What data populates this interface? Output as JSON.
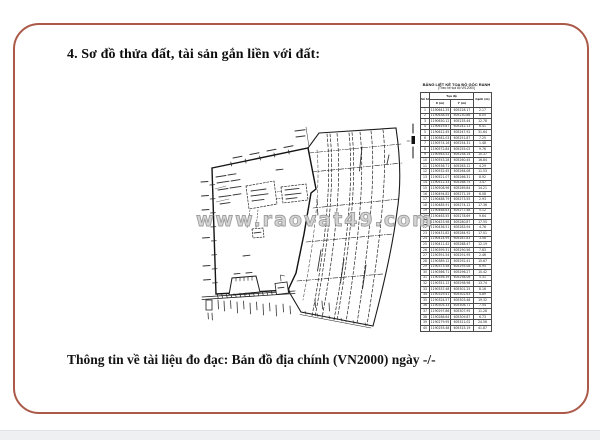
{
  "page": {
    "title": "4. Sơ đồ thửa đất, tài sản gắn liền với đất:",
    "footer": "Thông tin về tài liệu đo đạc: Bản đồ địa chính (VN2000) ngày -/-",
    "watermark": "www.raovat49.com",
    "frame_color": "#ab5948"
  },
  "coordinate_table": {
    "title_line1": "BẢNG LIỆT KÊ TỌA ĐỘ GÓC RANH",
    "title_line2": "(Theo hệ tọa độ VN-2000)",
    "headers": {
      "point": "Số hiệu điểm",
      "coords": "Tọa độ",
      "x": "X (m)",
      "y": "Y (m)",
      "edge": "Cạnh (m)"
    },
    "rows": [
      {
        "n": "1",
        "x": "1190641.25",
        "y": "605228.17",
        "d": "2.17"
      },
      {
        "n": "2",
        "x": "1190638.54",
        "y": "605230.86",
        "d": "8.05"
      },
      {
        "n": "3",
        "x": "1190630.12",
        "y": "605235.44",
        "d": "12.78"
      },
      {
        "n": "4",
        "x": "1190619.87",
        "y": "605242.13",
        "d": "6.41"
      },
      {
        "n": "5",
        "x": "1190612.45",
        "y": "605247.92",
        "d": "31.64"
      },
      {
        "n": "6",
        "x": "1190581.03",
        "y": "605251.87",
        "d": "7.25"
      },
      {
        "n": "7",
        "x": "1190574.16",
        "y": "605254.31",
        "d": "1.48"
      },
      {
        "n": "8",
        "x": "1190572.84",
        "y": "605255.02",
        "d": "9.76"
      },
      {
        "n": "9",
        "x": "1190563.52",
        "y": "605258.14",
        "d": "10.37"
      },
      {
        "n": "10",
        "x": "1190553.28",
        "y": "605260.45",
        "d": "16.84"
      },
      {
        "n": "11",
        "x": "1190536.71",
        "y": "605263.12",
        "d": "4.29"
      },
      {
        "n": "12",
        "x": "1190532.45",
        "y": "605264.08",
        "d": "11.53"
      },
      {
        "n": "13",
        "x": "1190521.07",
        "y": "605266.31",
        "d": "8.92"
      },
      {
        "n": "14",
        "x": "1190512.33",
        "y": "605268.75",
        "d": "3.47"
      },
      {
        "n": "15",
        "x": "1190508.96",
        "y": "605269.84",
        "d": "14.21"
      },
      {
        "n": "16",
        "x": "1190494.82",
        "y": "605272.19",
        "d": "6.08"
      },
      {
        "n": "17",
        "x": "1190488.79",
        "y": "605273.55",
        "d": "2.93"
      },
      {
        "n": "18",
        "x": "1190485.91",
        "y": "605274.12",
        "d": "17.36"
      },
      {
        "n": "19",
        "x": "1190468.63",
        "y": "605277.48",
        "d": "5.12"
      },
      {
        "n": "20",
        "x": "1190463.55",
        "y": "605278.69",
        "d": "9.64"
      },
      {
        "n": "21",
        "x": "1190453.98",
        "y": "605280.87",
        "d": "17.55"
      },
      {
        "n": "22",
        "x": "1190436.51",
        "y": "605283.94",
        "d": "4.76"
      },
      {
        "n": "23",
        "x": "1190431.82",
        "y": "605284.92",
        "d": "17.01"
      },
      {
        "n": "24",
        "x": "1190414.95",
        "y": "605287.83",
        "d": "3.58"
      },
      {
        "n": "25",
        "x": "1190411.42",
        "y": "605288.47",
        "d": "12.19"
      },
      {
        "n": "26",
        "x": "1190399.31",
        "y": "605290.56",
        "d": "7.83"
      },
      {
        "n": "27",
        "x": "1190391.54",
        "y": "605291.95",
        "d": "2.46"
      },
      {
        "n": "28",
        "x": "1190389.12",
        "y": "605292.41",
        "d": "15.67"
      },
      {
        "n": "29",
        "x": "1190373.58",
        "y": "605295.08",
        "d": "6.95"
      },
      {
        "n": "30",
        "x": "1190366.71",
        "y": "605296.27",
        "d": "10.42"
      },
      {
        "n": "31",
        "x": "1190356.39",
        "y": "605298.06",
        "d": "5.31"
      },
      {
        "n": "32",
        "x": "1190351.12",
        "y": "605298.98",
        "d": "13.74"
      },
      {
        "n": "33",
        "x": "1190337.48",
        "y": "605301.25",
        "d": "8.16"
      },
      {
        "n": "34",
        "x": "1190329.41",
        "y": "605302.63",
        "d": "4.89"
      },
      {
        "n": "35",
        "x": "1190324.57",
        "y": "605303.48",
        "d": "19.32"
      },
      {
        "n": "36",
        "x": "1190305.33",
        "y": "605306.71",
        "d": "7.54"
      },
      {
        "n": "37",
        "x": "1190297.86",
        "y": "605307.95",
        "d": "11.28"
      },
      {
        "n": "38",
        "x": "1190286.64",
        "y": "605309.87",
        "d": "6.73"
      },
      {
        "n": "39",
        "x": "1190279.95",
        "y": "605311.02",
        "d": "24.56"
      },
      {
        "n": "40",
        "x": "1190255.48",
        "y": "605315.19",
        "d": "41.87"
      }
    ]
  }
}
